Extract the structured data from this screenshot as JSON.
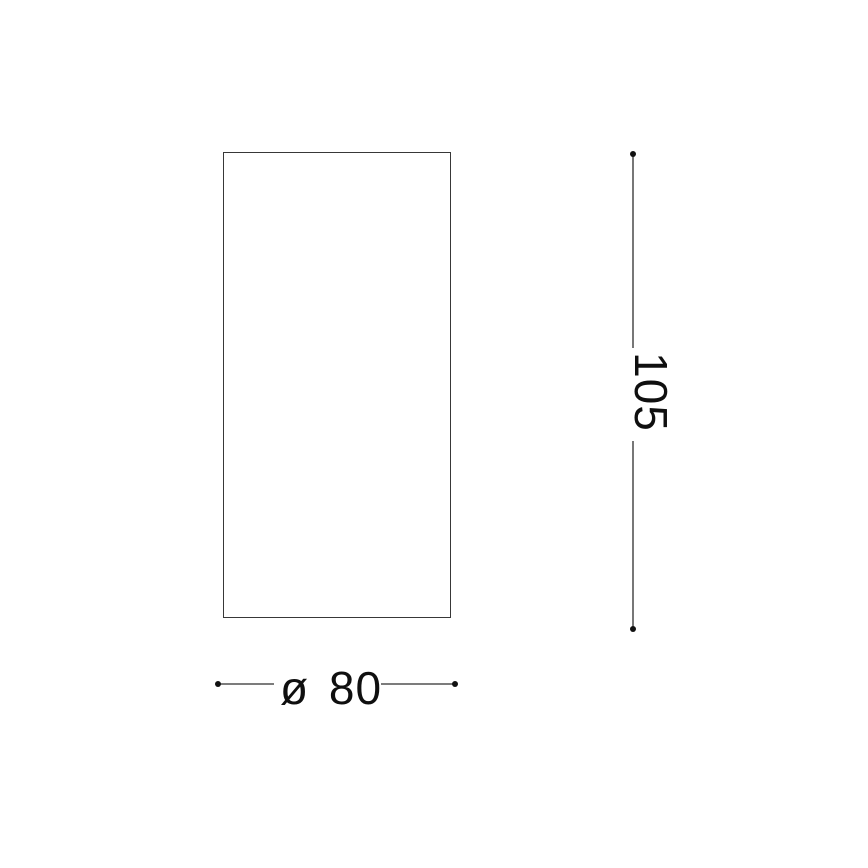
{
  "drawing": {
    "type": "technical-dimension-drawing",
    "shape": "rectangle-outline",
    "colors": {
      "background": "#ffffff",
      "outline": "#383838",
      "line": "#2e2e2e",
      "dot": "#111111",
      "text": "#0f0f0f"
    },
    "dimensions": {
      "height": {
        "label": "105",
        "orientation": "vertical",
        "side": "right"
      },
      "diameter": {
        "label": "ø 80",
        "symbol": "ø",
        "value": "80",
        "orientation": "horizontal",
        "side": "bottom"
      }
    }
  }
}
